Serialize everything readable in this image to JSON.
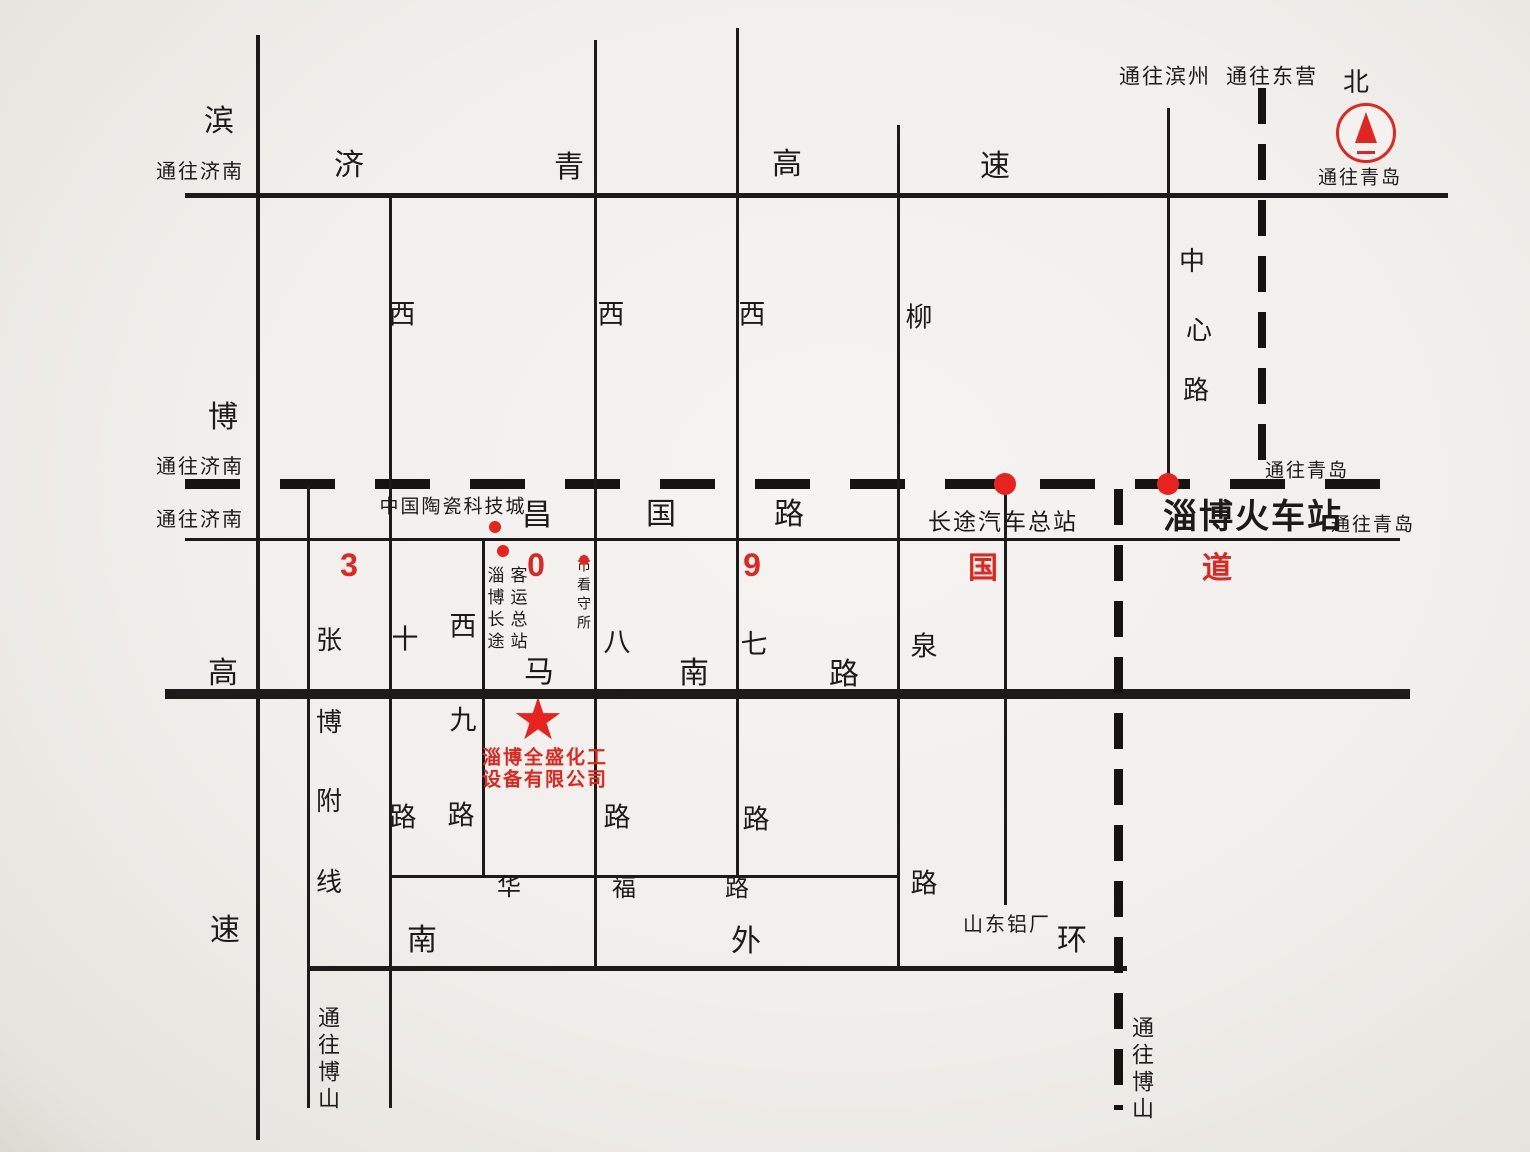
{
  "colors": {
    "road": "#1d1b19",
    "accent_red": "#e0261f",
    "background": "#f1efeb"
  },
  "star": {
    "glyph": "★",
    "x": 538,
    "y": 720,
    "size": 58
  },
  "compass": {
    "x": 1366,
    "y": 133,
    "r": 27
  },
  "dots": [
    {
      "id": "dot-bus-terminal-309",
      "x": 1005,
      "y": 484,
      "r": 11
    },
    {
      "id": "dot-railway-station-309",
      "x": 1168,
      "y": 484,
      "r": 11
    },
    {
      "id": "dot-ceramic-city",
      "x": 495,
      "y": 527,
      "r": 6
    },
    {
      "id": "dot-longdistance-bus",
      "x": 503,
      "y": 551,
      "r": 6
    },
    {
      "id": "dot-detention-house",
      "x": 584,
      "y": 560,
      "r": 5
    }
  ],
  "roads": {
    "horizontal": [
      {
        "name": "jiqing-expressway",
        "x1": 185,
        "x2": 1448,
        "y": 195,
        "t": 5,
        "style": "solid"
      },
      {
        "name": "g309-national-road",
        "x1": 185,
        "x2": 1415,
        "y": 484,
        "t": 10,
        "style": "dashed-h"
      },
      {
        "name": "changguo-road",
        "x1": 185,
        "x2": 1400,
        "y": 539,
        "t": 3,
        "style": "solid"
      },
      {
        "name": "manan-road",
        "x1": 165,
        "x2": 1410,
        "y": 694,
        "t": 10,
        "style": "solid"
      },
      {
        "name": "huafu-road",
        "x1": 390,
        "x2": 898,
        "y": 876,
        "t": 3,
        "style": "solid"
      },
      {
        "name": "south-outer-ring-road",
        "x1": 308,
        "x2": 1127,
        "y": 968,
        "t": 5,
        "style": "solid"
      }
    ],
    "vertical": [
      {
        "name": "binbo-expressway",
        "x": 258,
        "y1": 35,
        "y2": 1140,
        "t": 4,
        "style": "solid"
      },
      {
        "name": "zhangbo-branch-line",
        "x": 308,
        "y1": 486,
        "y2": 1108,
        "t": 3,
        "style": "solid"
      },
      {
        "name": "west-10th-road",
        "x": 390,
        "y1": 195,
        "y2": 1108,
        "t": 3,
        "style": "solid"
      },
      {
        "name": "west-9th-road",
        "x": 483,
        "y1": 539,
        "y2": 877,
        "t": 3,
        "style": "solid"
      },
      {
        "name": "west-8th-road",
        "x": 595,
        "y1": 40,
        "y2": 969,
        "t": 3,
        "style": "solid"
      },
      {
        "name": "west-7th-road",
        "x": 737,
        "y1": 28,
        "y2": 877,
        "t": 3,
        "style": "solid"
      },
      {
        "name": "liuquan-road",
        "x": 898,
        "y1": 125,
        "y2": 969,
        "t": 3,
        "style": "solid"
      },
      {
        "name": "bus-terminal-road",
        "x": 1005,
        "y1": 486,
        "y2": 905,
        "t": 3,
        "style": "solid"
      },
      {
        "name": "center-road",
        "x": 1168,
        "y1": 108,
        "y2": 489,
        "t": 3,
        "style": "solid"
      },
      {
        "name": "ring-road-south-extension",
        "x": 1118,
        "y1": 489,
        "y2": 1110,
        "t": 9,
        "style": "dashed-v"
      },
      {
        "name": "to-dongying-road",
        "x": 1262,
        "y1": 88,
        "y2": 486,
        "t": 8,
        "style": "dashed-v"
      }
    ]
  },
  "labels": [
    {
      "id": "binbo-expwy-char-bin",
      "text": "滨",
      "x": 220,
      "y": 122,
      "fs": 30
    },
    {
      "id": "binbo-expwy-char-bo",
      "text": "博",
      "x": 224,
      "y": 418,
      "fs": 30
    },
    {
      "id": "binbo-expwy-char-gao",
      "text": "高",
      "x": 224,
      "y": 674,
      "fs": 30
    },
    {
      "id": "binbo-expwy-char-su",
      "text": "速",
      "x": 226,
      "y": 931,
      "fs": 30
    },
    {
      "id": "jiqing-expwy-char-ji",
      "text": "济",
      "x": 350,
      "y": 166,
      "fs": 30
    },
    {
      "id": "jiqing-expwy-char-qing",
      "text": "青",
      "x": 570,
      "y": 168,
      "fs": 30
    },
    {
      "id": "jiqing-expwy-char-gao",
      "text": "高",
      "x": 788,
      "y": 165,
      "fs": 30
    },
    {
      "id": "jiqing-expwy-char-su",
      "text": "速",
      "x": 996,
      "y": 167,
      "fs": 30
    },
    {
      "id": "to-jinan-top",
      "text": "通往济南",
      "x": 200,
      "y": 172,
      "fs": 20
    },
    {
      "id": "to-jinan-middle",
      "text": "通往济南",
      "x": 200,
      "y": 467,
      "fs": 20
    },
    {
      "id": "to-jinan-changguo",
      "text": "通往济南",
      "x": 200,
      "y": 520,
      "fs": 20
    },
    {
      "id": "to-binzhou",
      "text": "通往滨州",
      "x": 1165,
      "y": 77,
      "fs": 21
    },
    {
      "id": "to-dongying",
      "text": "通往东营",
      "x": 1272,
      "y": 77,
      "fs": 21
    },
    {
      "id": "north-label",
      "text": "北",
      "x": 1357,
      "y": 82,
      "fs": 26
    },
    {
      "id": "to-qingdao-top",
      "text": "通往青岛",
      "x": 1360,
      "y": 178,
      "fs": 19
    },
    {
      "id": "to-qingdao-309",
      "text": "通往青岛",
      "x": 1307,
      "y": 471,
      "fs": 19
    },
    {
      "id": "to-qingdao-changguo",
      "text": "通往青岛",
      "x": 1373,
      "y": 525,
      "fs": 19
    },
    {
      "id": "center-road-char-zhong",
      "text": "中",
      "x": 1193,
      "y": 261,
      "fs": 26
    },
    {
      "id": "center-road-char-xin",
      "text": "心",
      "x": 1200,
      "y": 330,
      "fs": 26
    },
    {
      "id": "center-road-char-lu",
      "text": "路",
      "x": 1197,
      "y": 390,
      "fs": 26
    },
    {
      "id": "ceramic-city",
      "text": "中国陶瓷科技城",
      "x": 453,
      "y": 507,
      "fs": 19
    },
    {
      "id": "changguo-char-chang",
      "text": "昌",
      "x": 538,
      "y": 516,
      "fs": 30
    },
    {
      "id": "changguo-char-guo",
      "text": "国",
      "x": 662,
      "y": 515,
      "fs": 30
    },
    {
      "id": "changguo-char-lu",
      "text": "路",
      "x": 790,
      "y": 515,
      "fs": 30
    },
    {
      "id": "bus-terminal",
      "text": "长途汽车总站",
      "x": 1003,
      "y": 522,
      "fs": 23
    },
    {
      "id": "railway-station",
      "text": "淄博火车站",
      "x": 1253,
      "y": 517,
      "fs": 34,
      "b": true
    },
    {
      "id": "west10-char-xi",
      "text": "西",
      "x": 403,
      "y": 315,
      "fs": 27
    },
    {
      "id": "west10-char-shi",
      "text": "十",
      "x": 406,
      "y": 640,
      "fs": 27
    },
    {
      "id": "west10-char-lu",
      "text": "路",
      "x": 404,
      "y": 818,
      "fs": 27
    },
    {
      "id": "west9-char-xi",
      "text": "西",
      "x": 464,
      "y": 627,
      "fs": 27
    },
    {
      "id": "west9-char-jiu",
      "text": "九",
      "x": 464,
      "y": 721,
      "fs": 27
    },
    {
      "id": "west9-char-lu",
      "text": "路",
      "x": 462,
      "y": 816,
      "fs": 27
    },
    {
      "id": "west8-char-xi",
      "text": "西",
      "x": 612,
      "y": 315,
      "fs": 27
    },
    {
      "id": "west8-char-ba",
      "text": "八",
      "x": 618,
      "y": 643,
      "fs": 27
    },
    {
      "id": "west8-char-lu",
      "text": "路",
      "x": 618,
      "y": 818,
      "fs": 27
    },
    {
      "id": "west7-char-xi",
      "text": "西",
      "x": 753,
      "y": 315,
      "fs": 27
    },
    {
      "id": "west7-char-qi",
      "text": "七",
      "x": 755,
      "y": 645,
      "fs": 27
    },
    {
      "id": "west7-char-lu",
      "text": "路",
      "x": 757,
      "y": 820,
      "fs": 27
    },
    {
      "id": "liuquan-char-liu",
      "text": "柳",
      "x": 920,
      "y": 318,
      "fs": 27
    },
    {
      "id": "liuquan-char-quan",
      "text": "泉",
      "x": 925,
      "y": 647,
      "fs": 27
    },
    {
      "id": "liuquan-char-lu",
      "text": "路",
      "x": 925,
      "y": 884,
      "fs": 27
    },
    {
      "id": "manan-char-ma",
      "text": "马",
      "x": 540,
      "y": 673,
      "fs": 30
    },
    {
      "id": "manan-char-nan",
      "text": "南",
      "x": 695,
      "y": 674,
      "fs": 30
    },
    {
      "id": "manan-char-lu",
      "text": "路",
      "x": 845,
      "y": 675,
      "fs": 30
    },
    {
      "id": "zhangbo-char-zhang",
      "text": "张",
      "x": 330,
      "y": 640,
      "fs": 26
    },
    {
      "id": "zhangbo-char-bo",
      "text": "博",
      "x": 330,
      "y": 722,
      "fs": 26
    },
    {
      "id": "zhangbo-char-fu",
      "text": "附",
      "x": 330,
      "y": 801,
      "fs": 26
    },
    {
      "id": "zhangbo-char-xian",
      "text": "线",
      "x": 330,
      "y": 882,
      "fs": 26
    },
    {
      "id": "longdistance-bus-col-1",
      "text": "淄博长途",
      "x": 494,
      "y": 610,
      "fs": 17,
      "v": true
    },
    {
      "id": "longdistance-bus-col-2",
      "text": "客运总站",
      "x": 517,
      "y": 610,
      "fs": 17,
      "v": true
    },
    {
      "id": "detention-house",
      "text": "市看守所",
      "x": 584,
      "y": 596,
      "fs": 14,
      "v": true
    },
    {
      "id": "huafu-char-hua",
      "text": "华",
      "x": 510,
      "y": 888,
      "fs": 24
    },
    {
      "id": "huafu-char-fu",
      "text": "福",
      "x": 625,
      "y": 889,
      "fs": 24
    },
    {
      "id": "huafu-char-lu",
      "text": "路",
      "x": 738,
      "y": 889,
      "fs": 24
    },
    {
      "id": "ring-char-nan",
      "text": "南",
      "x": 423,
      "y": 941,
      "fs": 30
    },
    {
      "id": "ring-char-wai",
      "text": "外",
      "x": 747,
      "y": 942,
      "fs": 30
    },
    {
      "id": "ring-char-huan",
      "text": "环",
      "x": 1073,
      "y": 941,
      "fs": 30
    },
    {
      "id": "shandong-aluminum",
      "text": "山东铝厂",
      "x": 1007,
      "y": 925,
      "fs": 20
    },
    {
      "id": "to-boshan-left",
      "text": "通往博山",
      "x": 327,
      "y": 1060,
      "fs": 22,
      "v": true
    },
    {
      "id": "to-boshan-right",
      "text": "通往博山",
      "x": 1141,
      "y": 1070,
      "fs": 22,
      "v": true
    },
    {
      "id": "g309-char-3",
      "text": "3",
      "x": 350,
      "y": 565,
      "fs": 32,
      "color": "r",
      "b": true
    },
    {
      "id": "g309-char-0",
      "text": "0",
      "x": 537,
      "y": 565,
      "fs": 32,
      "color": "r",
      "b": true
    },
    {
      "id": "g309-char-9",
      "text": "9",
      "x": 753,
      "y": 565,
      "fs": 32,
      "color": "r",
      "b": true
    },
    {
      "id": "g309-char-guo",
      "text": "国",
      "x": 984,
      "y": 569,
      "fs": 30,
      "color": "r",
      "b": true
    },
    {
      "id": "g309-char-dao",
      "text": "道",
      "x": 1218,
      "y": 569,
      "fs": 30,
      "color": "r",
      "b": true
    },
    {
      "id": "company-name-line1",
      "text": "淄博全盛化工",
      "x": 545,
      "y": 758,
      "fs": 19,
      "color": "r",
      "b": true
    },
    {
      "id": "company-name-line2",
      "text": "设备有限公司",
      "x": 545,
      "y": 780,
      "fs": 19,
      "color": "r",
      "b": true
    }
  ]
}
